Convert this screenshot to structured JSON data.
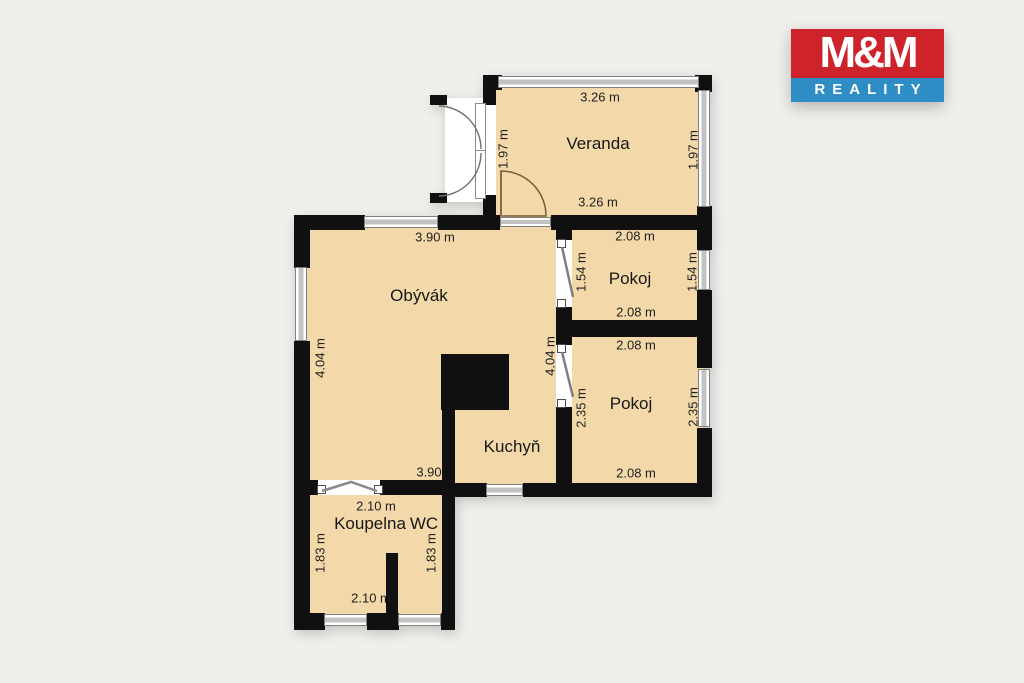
{
  "logo": {
    "title": "M&M",
    "subtitle": "REALITY",
    "red": "#cf232b",
    "blue": "#2f8dc5"
  },
  "colors": {
    "background": "#f0efeb",
    "room_fill": "#f3d9aa",
    "wall": "#101010",
    "window_glass": "#c3c3c3",
    "door_swing": "#7a5c38",
    "text": "#1f1f1f"
  },
  "rooms": {
    "veranda": {
      "name": "Veranda",
      "width_top": "3.26 m",
      "width_bottom": "3.26 m",
      "height_left": "1.97 m",
      "height_right": "1.97 m"
    },
    "pokoj_top": {
      "name": "Pokoj",
      "width_top": "2.08 m",
      "width_bottom": "2.08 m",
      "height_left": "1.54 m",
      "height_right": "1.54 m"
    },
    "pokoj_bottom": {
      "name": "Pokoj",
      "width_top": "2.08 m",
      "width_bottom": "2.08 m",
      "height_left": "2.35 m",
      "height_right": "2.35 m"
    },
    "obyvak": {
      "name": "Obývák",
      "width_top": "3.90 m",
      "width_bottom": "3.90",
      "height_left": "4.04 m",
      "height_right": "4.04 m"
    },
    "kuchyn": {
      "name": "Kuchyň"
    },
    "koupelna": {
      "name": "Koupelna",
      "wc_name": "WC",
      "width_top": "2.10 m",
      "width_bottom": "2.10 m",
      "height_left": "1.83 m",
      "height_right": "1.83 m"
    }
  }
}
